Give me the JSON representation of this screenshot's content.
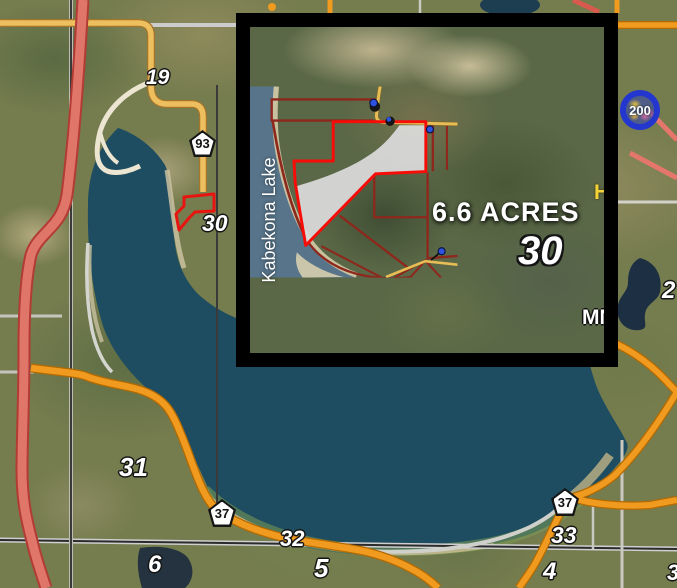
{
  "main_map": {
    "section_labels": {
      "n19": "19",
      "n30": "30",
      "n31": "31",
      "n32": "32",
      "n33": "33",
      "n4": "4",
      "n5": "5",
      "n6": "6"
    },
    "clipped_edge_labels": {
      "upper_right": "2",
      "lower_right": "3"
    },
    "county_shields": {
      "west_93": "93",
      "southwest_37": "37",
      "southeast_37": "37"
    },
    "state_route_marker": "200"
  },
  "inset": {
    "lake_label": "Kabekona Lake",
    "acreage_label": "6.6 ACRES",
    "section_label": "30",
    "clipped_label_mn": "MN",
    "clipped_label_h": "H"
  },
  "colors": {
    "inset_border": "#000000",
    "parcel_outline": "#f80c08",
    "parcel_fill": "#dcdcdc",
    "highway_orange": "#f09a20",
    "highway_red": "#df7166",
    "inset_road_maroon": "#8e271c",
    "lake_deep": "#1e4d61",
    "inset_lake": "#57748a",
    "marker_blue": "#2337cf",
    "shield_fill": "#ffffff"
  }
}
